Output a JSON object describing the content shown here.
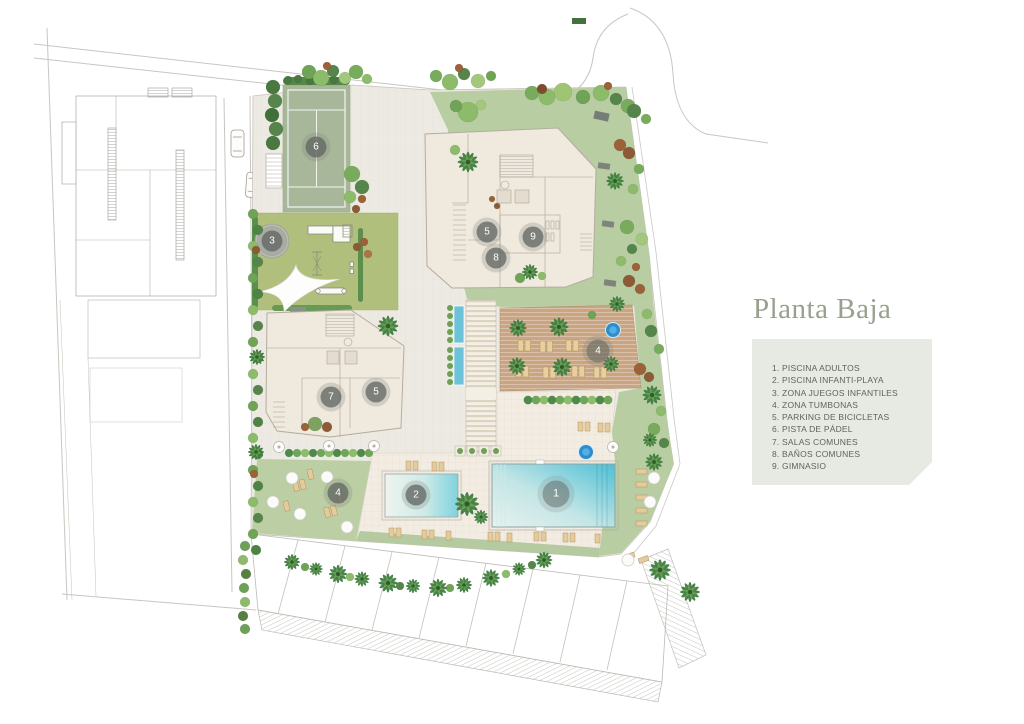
{
  "title": "Planta Baja",
  "legend": {
    "items": [
      "1. PISCINA ADULTOS",
      "2. PISCINA INFANTI-PLAYA",
      "3. ZONA JUEGOS INFANTILES",
      "4. ZONA TUMBONAS",
      "5. PARKING DE BICICLETAS",
      "6. PISTA DE PÁDEL",
      "7. SALAS COMUNES",
      "8. BAÑOS COMUNES",
      "9. GIMNASIO"
    ]
  },
  "plan": {
    "markers": [
      {
        "label": "6",
        "area": "pista-de-padel"
      },
      {
        "label": "3",
        "area": "zona-juegos-infantiles"
      },
      {
        "label": "5",
        "area": "parking-de-bicicletas"
      },
      {
        "label": "9",
        "area": "gimnasio"
      },
      {
        "label": "8",
        "area": "banos-comunes"
      },
      {
        "label": "7",
        "area": "salas-comunes"
      },
      {
        "label": "5",
        "area": "parking-de-bicicletas"
      },
      {
        "label": "4",
        "area": "zona-tumbonas"
      },
      {
        "label": "4",
        "area": "zona-tumbonas"
      },
      {
        "label": "2",
        "area": "piscina-infanti-playa"
      },
      {
        "label": "1",
        "area": "piscina-adultos"
      }
    ]
  },
  "colors": {
    "title_text": "#96a18e",
    "legend_bg": "#e7eae3",
    "legend_text": "#5f635c",
    "lawn_green": "#b9cda3",
    "playground_green": "#b1bf7d",
    "padel_green": "#a8b79a",
    "deck_tan": "#c9a582",
    "pool_blue": "#52c0d6",
    "jacuzzi_blue": "#2e8dcf",
    "building_beige": "#f0e9dd",
    "marker_gray": "#616661"
  }
}
